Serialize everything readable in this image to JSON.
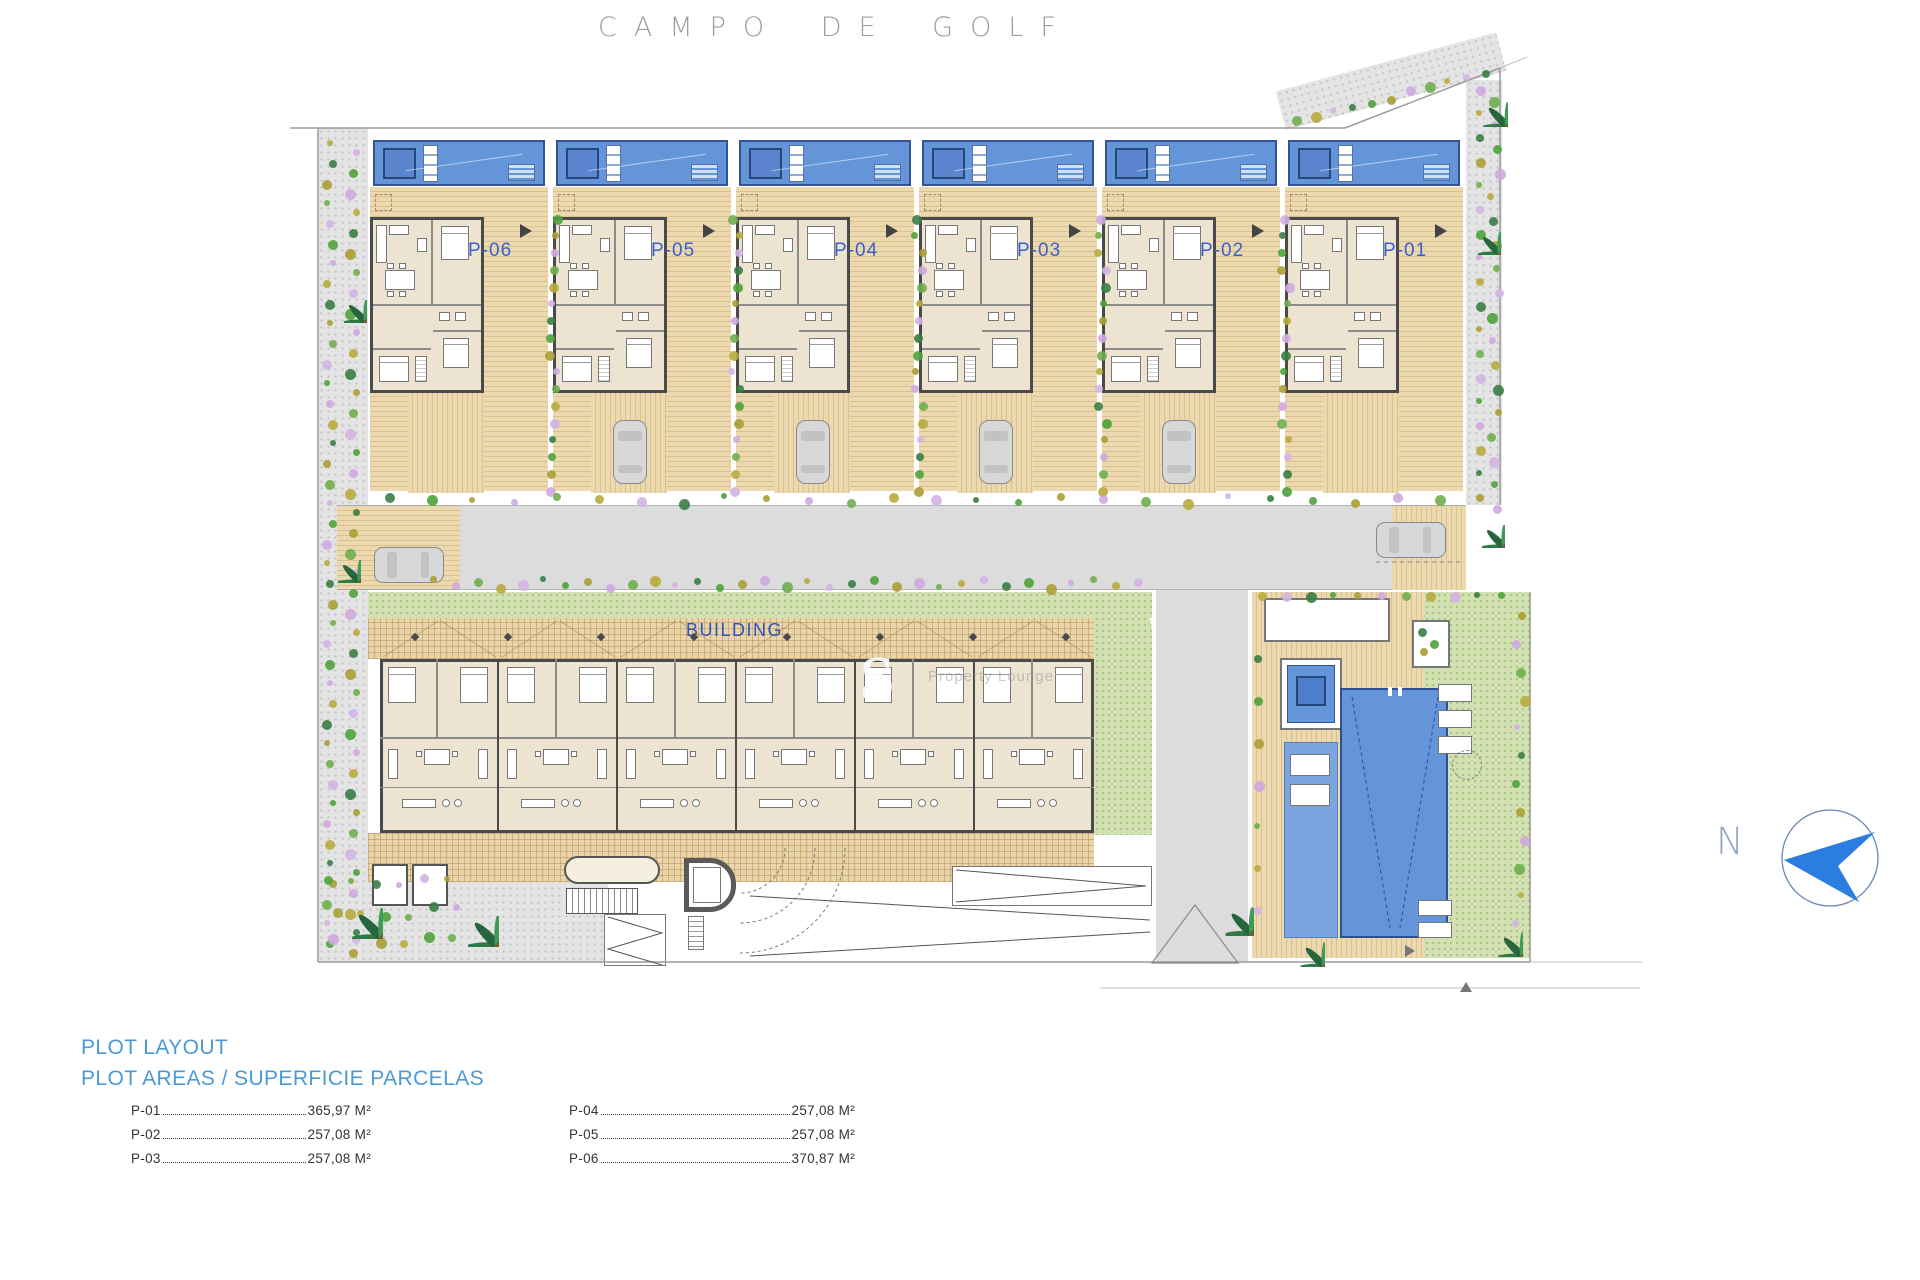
{
  "title": "CAMPO DE GOLF",
  "compass": {
    "label": "N"
  },
  "plan": {
    "building_label": "BUILDING",
    "plots": [
      {
        "label": "P-06"
      },
      {
        "label": "P-05"
      },
      {
        "label": "P-04"
      },
      {
        "label": "P-03"
      },
      {
        "label": "P-02"
      },
      {
        "label": "P-01"
      }
    ]
  },
  "watermark": {
    "letter": "S",
    "text": "Property Lounge"
  },
  "legend": {
    "heading_line1": "PLOT LAYOUT",
    "heading_line2": "PLOT AREAS / SUPERFICIE PARCELAS",
    "columns": [
      {
        "rows": [
          {
            "plot": "P-01",
            "area": "365,97 M²"
          },
          {
            "plot": "P-02",
            "area": "257,08 M²"
          },
          {
            "plot": "P-03",
            "area": "257,08 M²"
          }
        ]
      },
      {
        "rows": [
          {
            "plot": "P-04",
            "area": "257,08 M²"
          },
          {
            "plot": "P-05",
            "area": "257,08 M²"
          },
          {
            "plot": "P-06",
            "area": "370,87 M²"
          }
        ]
      }
    ]
  },
  "colors": {
    "plot_label_blue": "#3a5fd0",
    "legend_heading_blue": "#4b9ad6",
    "pool_blue": "#6495d8",
    "pool_dark_blue": "#5b86cf",
    "compass_blue": "#2b7de0",
    "deck_tan": "#ecd9b0",
    "lawn_green": "#d2e0b2",
    "road_gray": "#dcdcdc"
  }
}
